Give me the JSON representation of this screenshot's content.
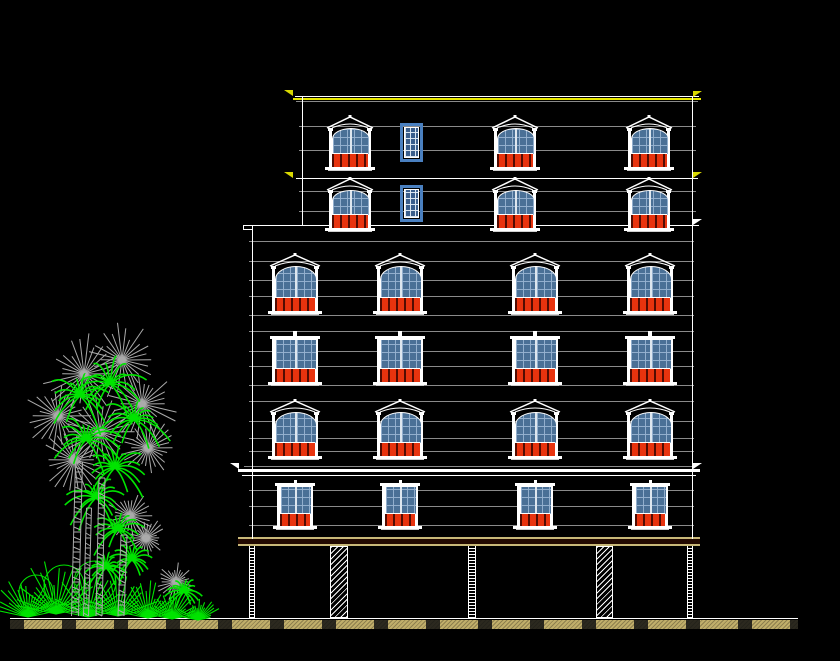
{
  "canvas": {
    "width": 840,
    "height": 661,
    "background": "#000000"
  },
  "colors": {
    "background": "#000000",
    "white": "#FFFFFF",
    "gray": "#8A8A8A",
    "yellow": "#E8E800",
    "tan": "#C8B878",
    "darkband": "#220900",
    "glazing": "#4A7096",
    "muntin": "#96B2D0",
    "panel_red": "#E8330E",
    "small_frame": "#4A80C0",
    "small_glazing": "#3A5E8C",
    "ground_tan": "#C0AE6A",
    "tree_green": "#00E400",
    "tree_gray": "#ABABAB"
  },
  "elevation": {
    "h_lines": [
      {
        "y": 96,
        "x1": 295,
        "x2": 699,
        "c": "white"
      },
      {
        "y": 98,
        "x1": 293,
        "x2": 701,
        "h": 2,
        "c": "yellow"
      },
      {
        "y": 101,
        "x1": 296,
        "x2": 698,
        "c": "gray"
      },
      {
        "y": 126,
        "x1": 299,
        "x2": 696,
        "c": "gray"
      },
      {
        "y": 150,
        "x1": 299,
        "x2": 696,
        "c": "gray"
      },
      {
        "y": 178,
        "x1": 296,
        "x2": 698,
        "c": "white"
      },
      {
        "y": 191,
        "x1": 299,
        "x2": 696,
        "c": "gray"
      },
      {
        "y": 211,
        "x1": 299,
        "x2": 696,
        "c": "gray"
      },
      {
        "y": 225,
        "x1": 243,
        "x2": 699,
        "c": "white"
      },
      {
        "y": 229,
        "x1": 243,
        "x2": 253,
        "c": "white"
      },
      {
        "y": 241,
        "x1": 249,
        "x2": 694,
        "c": "gray"
      },
      {
        "y": 261,
        "x1": 249,
        "x2": 694,
        "c": "gray"
      },
      {
        "y": 280,
        "x1": 249,
        "x2": 694,
        "c": "gray"
      },
      {
        "y": 296,
        "x1": 249,
        "x2": 694,
        "c": "gray"
      },
      {
        "y": 315,
        "x1": 249,
        "x2": 694,
        "c": "gray"
      },
      {
        "y": 331,
        "x1": 249,
        "x2": 694,
        "c": "gray"
      },
      {
        "y": 351,
        "x1": 249,
        "x2": 694,
        "c": "gray"
      },
      {
        "y": 366,
        "x1": 249,
        "x2": 694,
        "c": "gray"
      },
      {
        "y": 385,
        "x1": 249,
        "x2": 694,
        "c": "gray"
      },
      {
        "y": 401,
        "x1": 249,
        "x2": 694,
        "c": "gray"
      },
      {
        "y": 421,
        "x1": 249,
        "x2": 694,
        "c": "gray"
      },
      {
        "y": 438,
        "x1": 249,
        "x2": 694,
        "c": "gray"
      },
      {
        "y": 451,
        "x1": 249,
        "x2": 694,
        "c": "gray"
      },
      {
        "y": 466,
        "x1": 244,
        "x2": 694,
        "c": "gray"
      },
      {
        "y": 469,
        "x1": 238,
        "x2": 700,
        "h": 3,
        "c": "white"
      },
      {
        "y": 475,
        "x1": 242,
        "x2": 696,
        "c": "white"
      },
      {
        "y": 490,
        "x1": 249,
        "x2": 694,
        "c": "gray"
      },
      {
        "y": 506,
        "x1": 249,
        "x2": 694,
        "c": "gray"
      },
      {
        "y": 525,
        "x1": 249,
        "x2": 694,
        "c": "gray"
      },
      {
        "y": 537,
        "x1": 238,
        "x2": 700,
        "h": 2,
        "c": "tan"
      },
      {
        "y": 539,
        "x1": 238,
        "x2": 700,
        "h": 5,
        "c": "darkband"
      },
      {
        "y": 544,
        "x1": 238,
        "x2": 700,
        "h": 2,
        "c": "tan"
      },
      {
        "y": 618,
        "x1": 10,
        "x2": 798,
        "c": "white"
      }
    ],
    "v_edges": [
      {
        "x": 302,
        "y1": 96,
        "y2": 226
      },
      {
        "x": 252,
        "y1": 225,
        "y2": 539
      },
      {
        "x": 692,
        "y1": 96,
        "y2": 539
      },
      {
        "x": 243,
        "y1": 225,
        "y2": 230
      }
    ],
    "window_rows": [
      {
        "style": "arched",
        "y": 115,
        "h": 57,
        "w": 42,
        "x": [
          329,
          494,
          628
        ],
        "small": {
          "x": 400,
          "y": 123,
          "w": 23,
          "h": 39
        }
      },
      {
        "style": "arched",
        "y": 177,
        "h": 56,
        "w": 42,
        "x": [
          329,
          494,
          628
        ],
        "small": {
          "x": 400,
          "y": 185,
          "w": 23,
          "h": 37
        }
      },
      {
        "style": "arched",
        "y": 253,
        "h": 63,
        "w": 46,
        "x": [
          272,
          377,
          512,
          627
        ]
      },
      {
        "style": "flat",
        "y": 331,
        "h": 56,
        "w": 46,
        "x": [
          272,
          377,
          512,
          627
        ]
      },
      {
        "style": "arched",
        "y": 399,
        "h": 62,
        "w": 46,
        "x": [
          272,
          377,
          512,
          627
        ]
      },
      {
        "style": "ground",
        "y": 480,
        "h": 51,
        "w": 36,
        "x": [
          277,
          382,
          517,
          632
        ]
      }
    ],
    "level_markers": [
      {
        "x": 284,
        "y": 90,
        "d": "e",
        "c": "#D8D800"
      },
      {
        "x": 693,
        "y": 91,
        "d": "w",
        "c": "#D8D800"
      },
      {
        "x": 284,
        "y": 172,
        "d": "e",
        "c": "#D8D800"
      },
      {
        "x": 693,
        "y": 172,
        "d": "w",
        "c": "#D8D800"
      },
      {
        "x": 693,
        "y": 219,
        "d": "w",
        "c": "#FFFFFF"
      },
      {
        "x": 230,
        "y": 463,
        "d": "e",
        "c": "#FFFFFF"
      },
      {
        "x": 693,
        "y": 463,
        "d": "w",
        "c": "#FFFFFF"
      }
    ],
    "pilotis": {
      "top": 546,
      "bottom": 618,
      "columns": [
        {
          "x": 249,
          "w": 6,
          "t": "n"
        },
        {
          "x": 330,
          "w": 18,
          "t": "w"
        },
        {
          "x": 468,
          "w": 8,
          "t": "n"
        },
        {
          "x": 596,
          "w": 17,
          "t": "w"
        },
        {
          "x": 687,
          "w": 6,
          "t": "n"
        }
      ]
    },
    "ground_band": {
      "x": 10,
      "y": 620,
      "w": 788,
      "h": 9
    }
  },
  "landscape": {
    "origin": {
      "x": 0,
      "y": 330,
      "w": 230,
      "h": 300
    },
    "palm_crowns_gray": [
      [
        84,
        44,
        42
      ],
      [
        122,
        30,
        40
      ],
      [
        58,
        86,
        36
      ],
      [
        142,
        74,
        38
      ],
      [
        100,
        102,
        42
      ],
      [
        74,
        130,
        34
      ],
      [
        148,
        118,
        30
      ],
      [
        130,
        186,
        26
      ],
      [
        146,
        208,
        22
      ],
      [
        176,
        252,
        20
      ]
    ],
    "palm_fronds_green": [
      [
        80,
        66,
        40
      ],
      [
        110,
        54,
        42
      ],
      [
        134,
        90,
        38
      ],
      [
        86,
        110,
        40
      ],
      [
        115,
        138,
        36
      ],
      [
        96,
        168,
        32
      ],
      [
        118,
        200,
        30
      ],
      [
        132,
        230,
        26
      ],
      [
        106,
        238,
        22
      ],
      [
        184,
        262,
        20
      ]
    ],
    "trunks": [
      [
        79,
        132,
        75,
        286,
        7
      ],
      [
        102,
        148,
        99,
        286,
        6
      ],
      [
        124,
        205,
        121,
        286,
        6
      ],
      [
        89,
        178,
        86,
        286,
        5
      ]
    ],
    "shrubs": [
      [
        28,
        287,
        42
      ],
      [
        56,
        284,
        54
      ],
      [
        88,
        287,
        46
      ],
      [
        118,
        286,
        42
      ],
      [
        148,
        288,
        38
      ],
      [
        172,
        289,
        32
      ],
      [
        198,
        290,
        24
      ]
    ],
    "circles": [
      [
        36,
        262,
        17
      ],
      [
        64,
        255,
        20
      ],
      [
        95,
        252,
        21
      ]
    ]
  }
}
